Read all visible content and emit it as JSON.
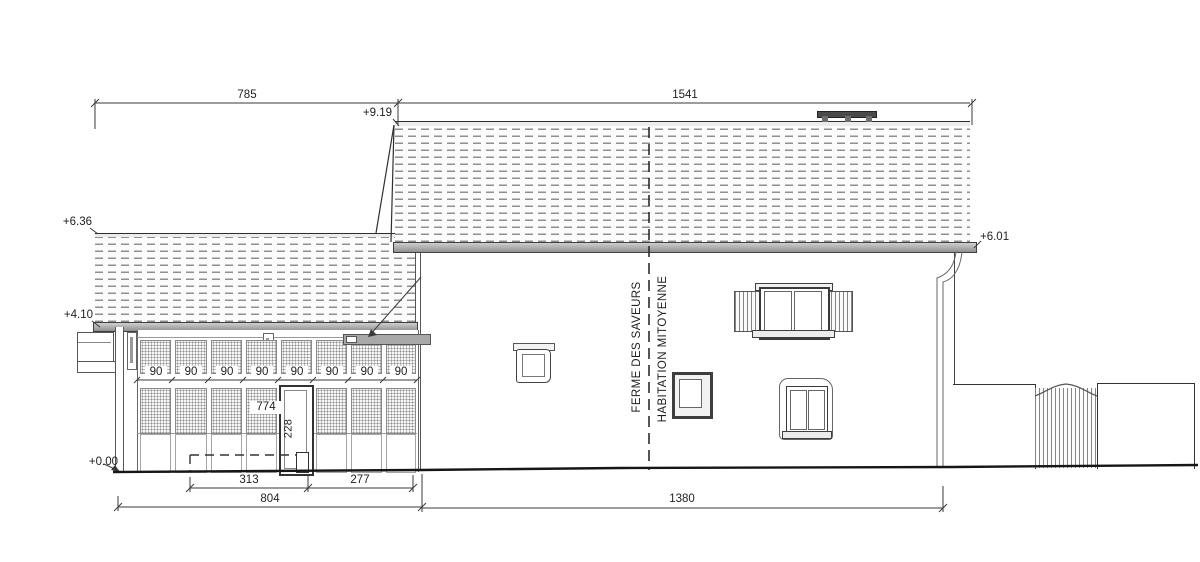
{
  "drawing": {
    "side_labels": {
      "left": "FERME DES SAVEURS",
      "right": "HABITATION MITOYENNE"
    },
    "levels": {
      "main_ridge": "+9.19",
      "left_ridge": "+6.36",
      "left_eave": "+4.10",
      "main_eave": "+6.01",
      "ground": "+0.00"
    },
    "dims": {
      "top_left": "785",
      "top_right": "1541",
      "bottom_313": "313",
      "bottom_277": "277",
      "bottom_804": "804",
      "bottom_1380": "1380",
      "door_width": "774",
      "door_height": "228",
      "bays": [
        "90",
        "90",
        "90",
        "90",
        "90",
        "90",
        "90",
        "90"
      ]
    }
  }
}
